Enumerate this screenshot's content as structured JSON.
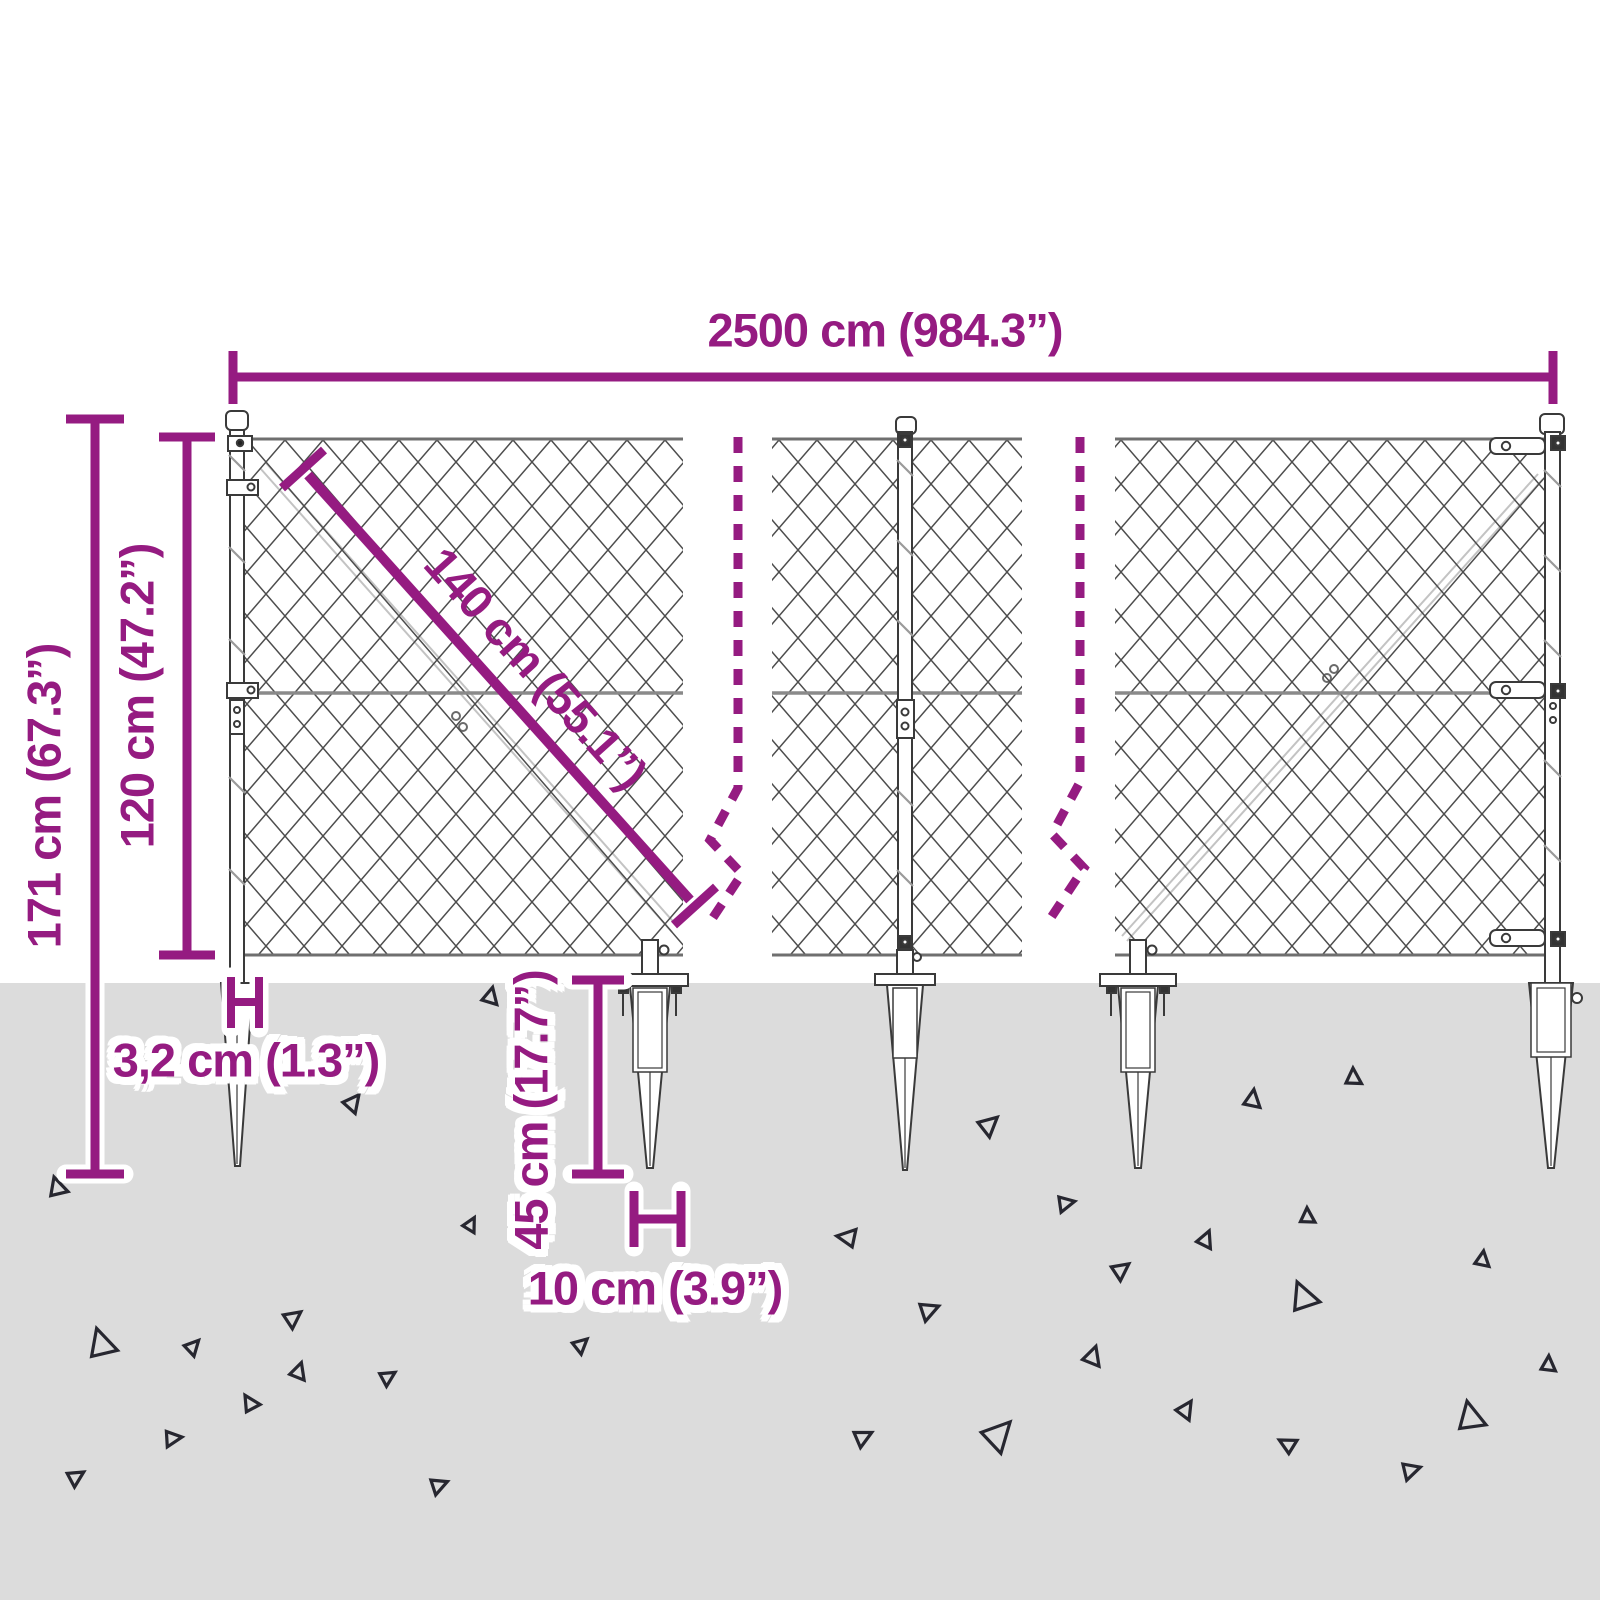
{
  "diagram": {
    "accent_color": "#951b81",
    "ground_color": "#dcdcdc",
    "fence_line_color": "#4d4d4d",
    "labels": {
      "total_width": "2500 cm (984.3”)",
      "total_height": "171 cm (67.3”)",
      "mesh_height": "120 cm (47.2”)",
      "brace_length": "140 cm (55.1”)",
      "post_width": "3,2 cm (1.3”)",
      "spike_depth": "45 cm (17.7”)",
      "spike_width": "10 cm (3.9”)"
    }
  }
}
